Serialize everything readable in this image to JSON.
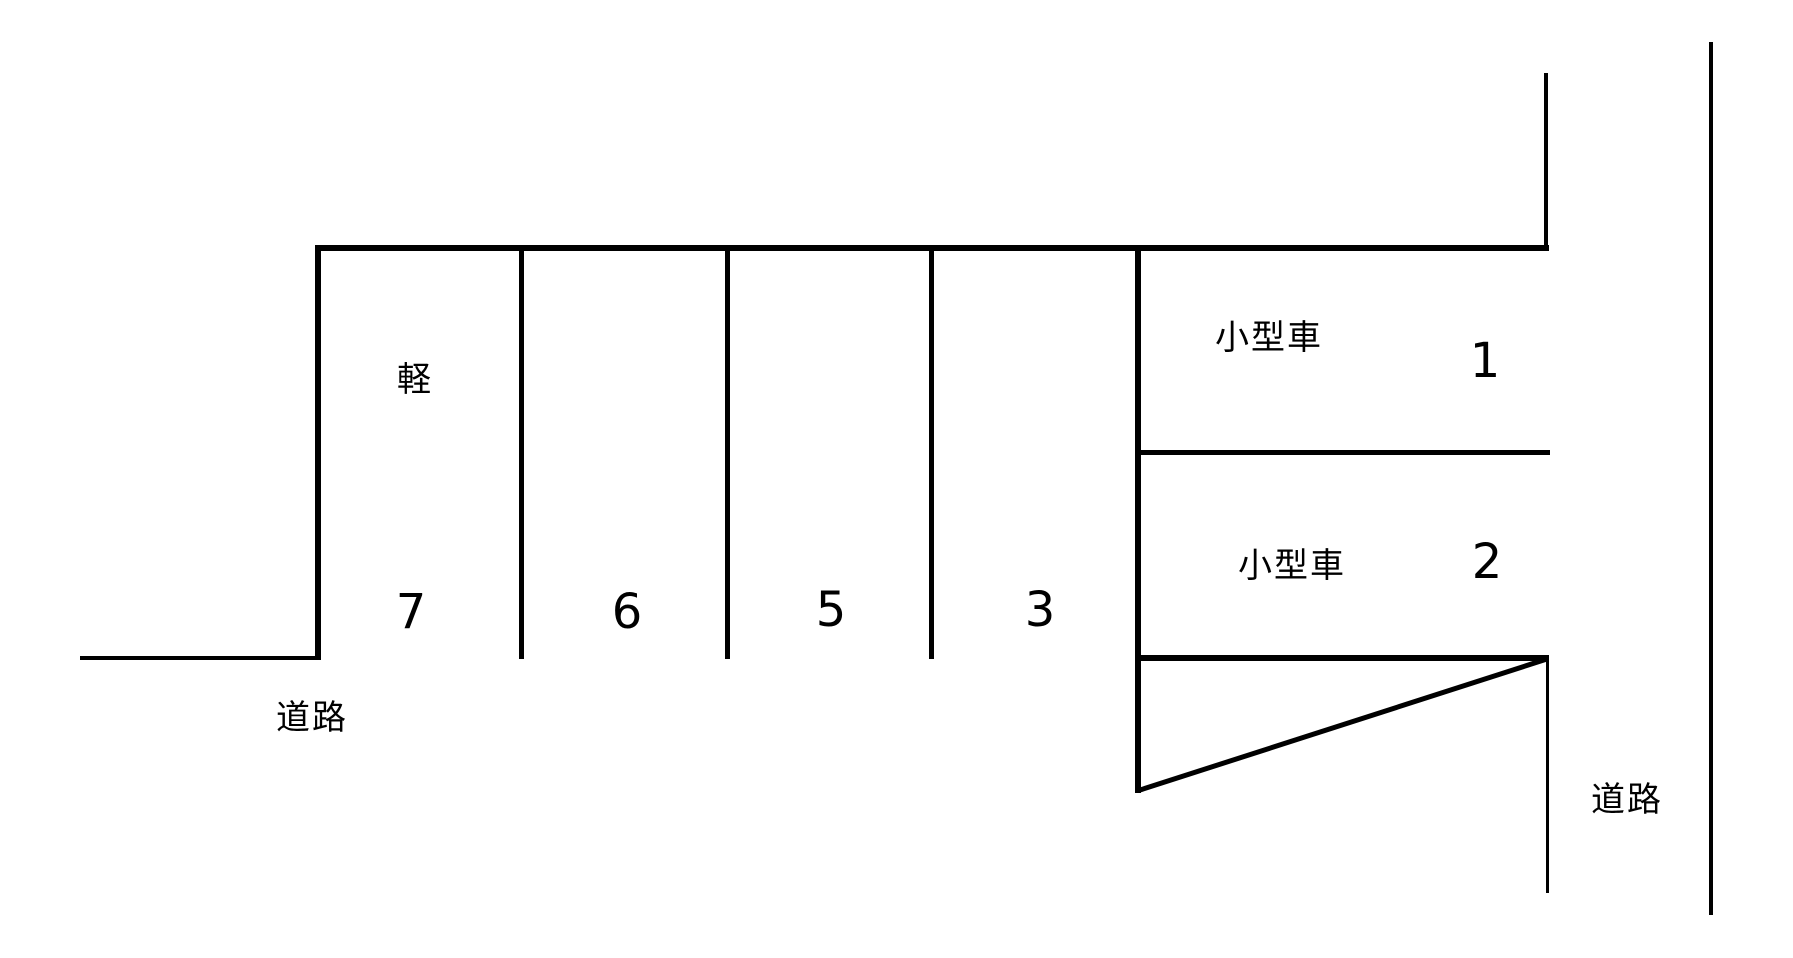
{
  "diagram_title": "parking-lot-layout",
  "colors": {
    "line": "#000000",
    "background": "#ffffff",
    "text": "#000000"
  },
  "parking_lot": {
    "spaces": [
      {
        "number": "7",
        "type_label": "軽"
      },
      {
        "number": "6",
        "type_label": ""
      },
      {
        "number": "5",
        "type_label": ""
      },
      {
        "number": "3",
        "type_label": ""
      },
      {
        "number": "1",
        "type_label": "小型車"
      },
      {
        "number": "2",
        "type_label": "小型車"
      }
    ],
    "roads": {
      "left": "道路",
      "right": "道路"
    }
  }
}
